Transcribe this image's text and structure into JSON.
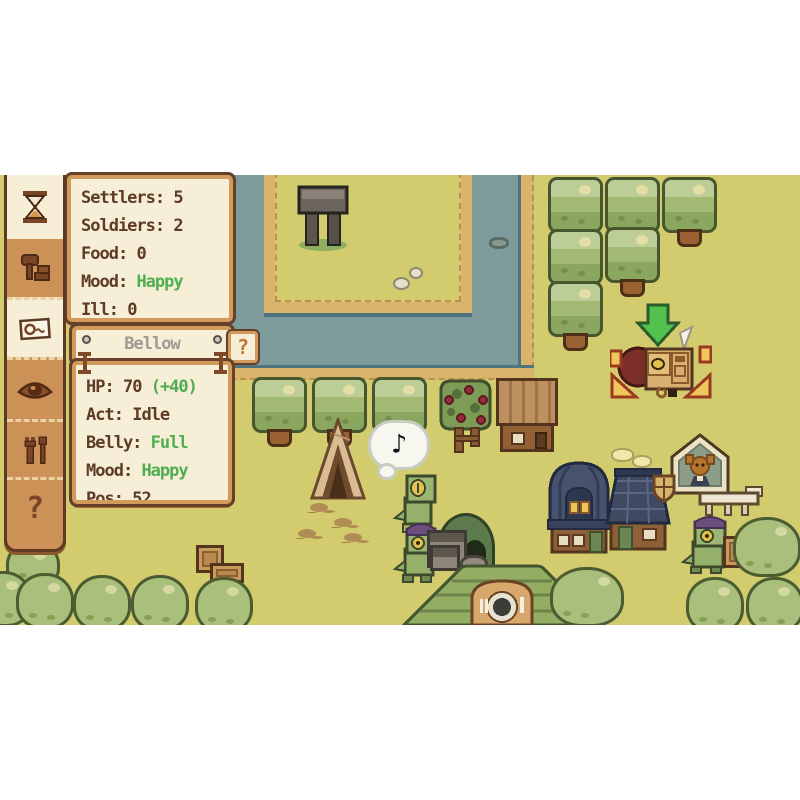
{
  "ui": {
    "sidebar": {
      "buttons": [
        {
          "id": "time",
          "icon": "hourglass-icon"
        },
        {
          "id": "build",
          "icon": "hammer-bricks-icon"
        },
        {
          "id": "log",
          "icon": "scroll-icon"
        },
        {
          "id": "view",
          "icon": "eye-icon"
        },
        {
          "id": "tools",
          "icon": "tools-icon"
        },
        {
          "id": "help",
          "icon": "question-icon",
          "label": "?"
        }
      ]
    },
    "stats_panel": {
      "rows": [
        {
          "label": "Settlers:",
          "value": "5"
        },
        {
          "label": "Soldiers:",
          "value": "2"
        },
        {
          "label": "Food:",
          "value": "0"
        },
        {
          "label": "Mood:",
          "value": "Happy"
        },
        {
          "label": "Ill:",
          "value": "0"
        }
      ]
    },
    "unit_panel": {
      "title": "Bellow",
      "help_label": "?",
      "rows": [
        {
          "label": "HP:",
          "value": "70",
          "bonus": "(+40)"
        },
        {
          "label": "Act:",
          "value": "Idle"
        },
        {
          "label": "Belly:",
          "value": "Full"
        },
        {
          "label": "Mood:",
          "value": "Happy"
        },
        {
          "label": "Pos:",
          "value": "52"
        }
      ]
    }
  },
  "world": {
    "speech_bubble": {
      "note": "♪"
    },
    "selected_unit": {
      "name": "Bellow"
    }
  },
  "colors": {
    "grass": "#d2cc6f",
    "water": "#7e9b9b",
    "sand": "#d9b56b",
    "panel_cream": "#f6eed6",
    "panel_tan": "#d29a5b",
    "panel_outline": "#66402a",
    "text_brown": "#5d3b26",
    "text_green": "#4fae52",
    "title_gray": "#9b9b93",
    "help_orange": "#c0763b",
    "selection_yellow": "#eec65c",
    "arrow_green": "#52c24f"
  }
}
